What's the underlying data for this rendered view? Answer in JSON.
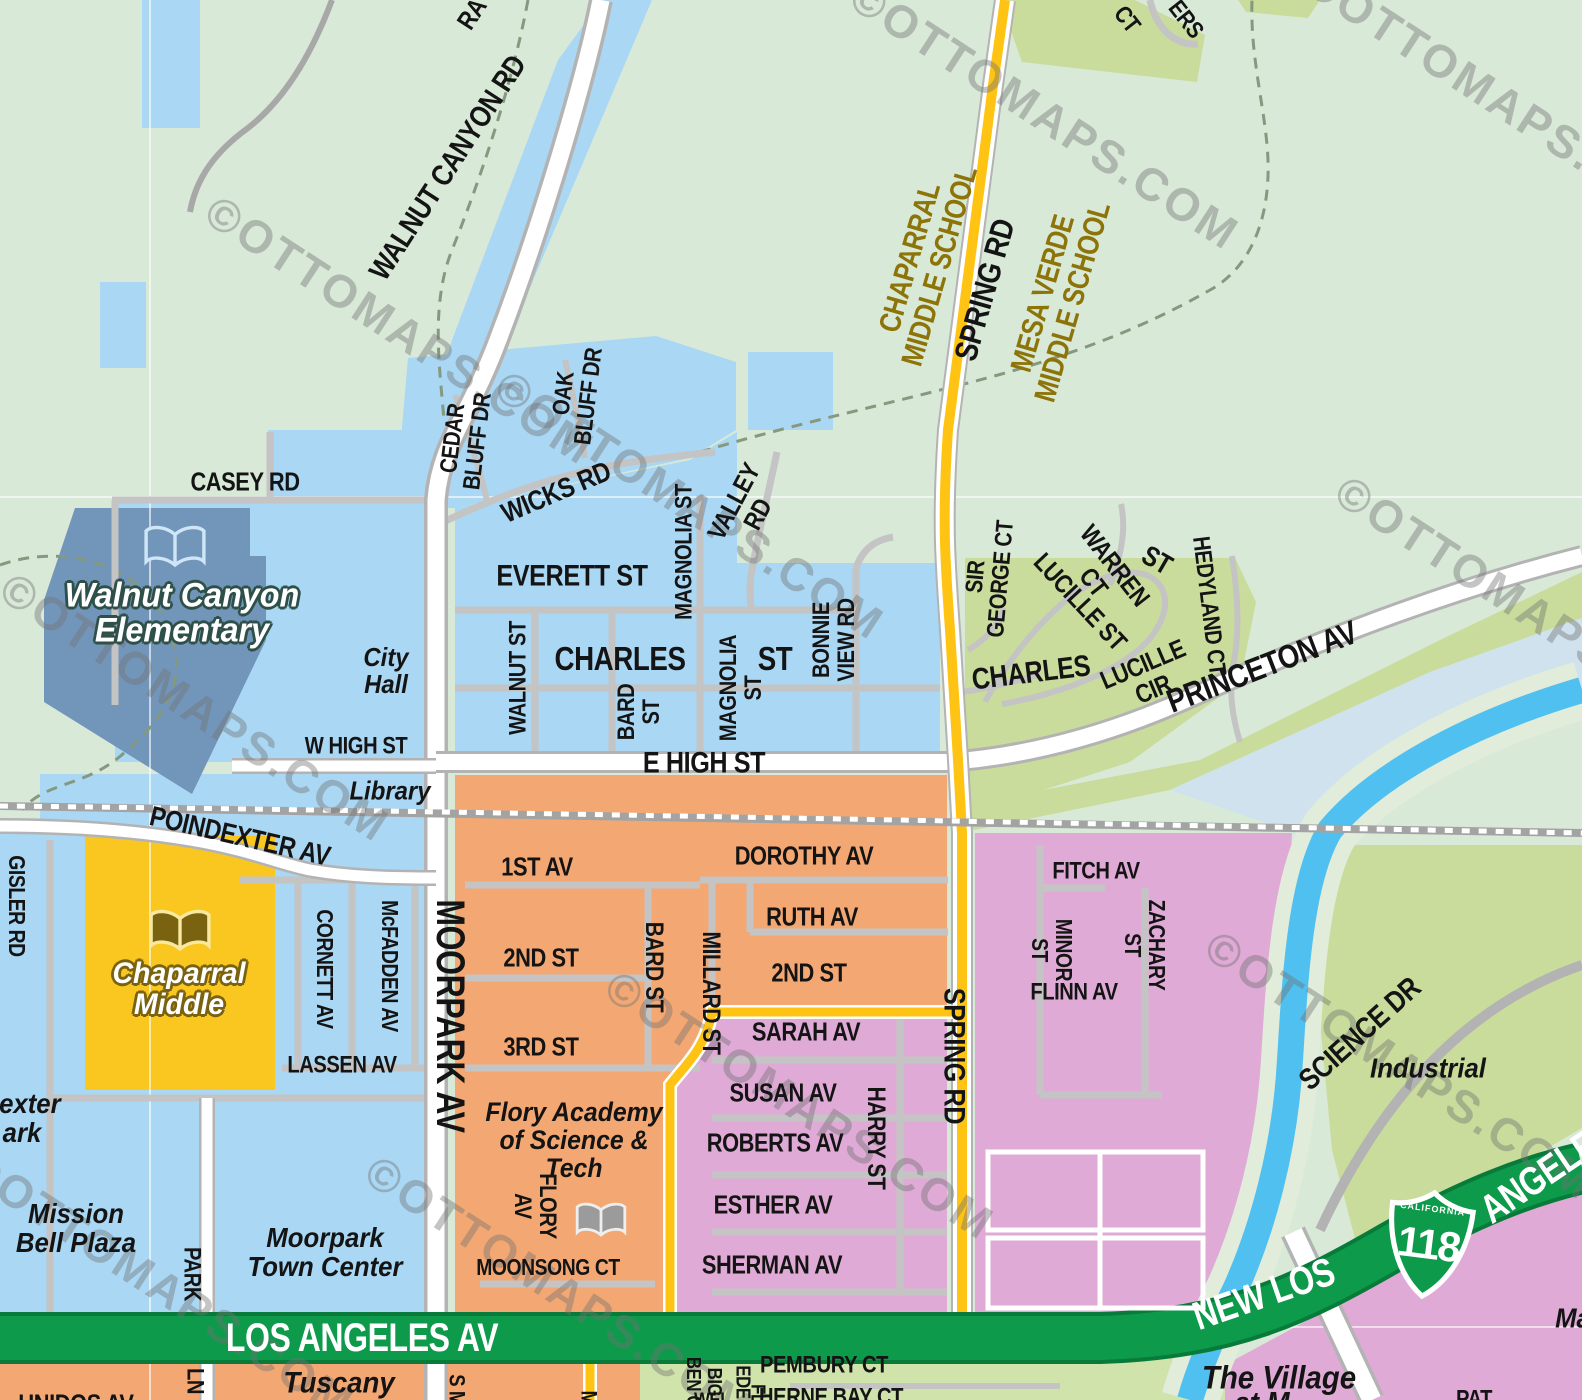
{
  "map": {
    "watermark_text": "©OTTOMAPS.COM",
    "shield": {
      "state": "CALIFORNIA",
      "number": "118"
    },
    "colors": {
      "park_green": "#d9e9d8",
      "residential_blue": "#a9d7f4",
      "downtown_orange": "#f3a873",
      "south_pink": "#dfaad6",
      "hill_green": "#c9dc9b",
      "school_yellow": "#f9c71f",
      "school_site_blue": "#7295ba",
      "river_blue": "#4fc0f0",
      "la_av_green": "#0d9a4b",
      "spring_rd_yellow": "#ffc413",
      "school_label_gold": "#8d7408"
    },
    "labels": {
      "walnut_canyon_rd": {
        "text": "WALNUT CANYON RD"
      },
      "ra_fragment": {
        "text": "RA"
      },
      "chaparral_middle_school": {
        "text": "CHAPARRAL\nMIDDLE SCHOOL"
      },
      "spring_rd_upper": {
        "text": "SPRING RD"
      },
      "mesa_verde_middle_school": {
        "text": "MESA VERDE\nMIDDLE SCHOOL"
      },
      "ct_fragment": {
        "text": "CT"
      },
      "ers_fragment": {
        "text": "ERS"
      },
      "casey_rd": {
        "text": "CASEY RD"
      },
      "walnut_canyon_elementary": {
        "text": "Walnut Canyon\nElementary"
      },
      "city_hall": {
        "text": "City\nHall"
      },
      "library": {
        "text": "Library"
      },
      "cedar_bluff_dr": {
        "text": "CEDAR\nBLUFF DR"
      },
      "oak_bluff_dr": {
        "text": "OAK\nBLUFF DR"
      },
      "wicks_rd": {
        "text": "WICKS RD"
      },
      "everett_st": {
        "text": "EVERETT ST"
      },
      "walnut_st": {
        "text": "WALNUT ST"
      },
      "charles_st": {
        "text": "CHARLES"
      },
      "charles_st_suffix": {
        "text": "ST"
      },
      "magnolia_st_n": {
        "text": "MAGNOLIA ST"
      },
      "magnolia_st_s": {
        "text": "MAGNOLIA\nST"
      },
      "bard_st_n": {
        "text": "BARD\nST"
      },
      "valley_rd": {
        "text": "VALLEY\nRD"
      },
      "bonnie_view_rd": {
        "text": "BONNIE\nVIEW RD"
      },
      "w_high_st": {
        "text": "W HIGH ST"
      },
      "e_high_st": {
        "text": "E HIGH ST"
      },
      "poindexter_av": {
        "text": "POINDEXTER AV"
      },
      "sir_george_ct": {
        "text": "SIR\nGEORGE CT"
      },
      "warren_ct": {
        "text": "WARREN\nCT"
      },
      "st_fragment": {
        "text": "ST"
      },
      "lucille_st": {
        "text": "LUCILLE ST"
      },
      "lucille_cir": {
        "text": "LUCILLE\nCIR"
      },
      "hedyland_ct": {
        "text": "HEDYLAND CT"
      },
      "princeton_av": {
        "text": "PRINCETON AV"
      },
      "charles_st_e": {
        "text": "CHARLES"
      },
      "gisler_rd": {
        "text": "GISLER RD"
      },
      "chaparral_middle": {
        "text": "Chaparral\nMiddle"
      },
      "cornett_av": {
        "text": "CORNETT AV"
      },
      "mcfadden_av": {
        "text": "McFADDEN AV"
      },
      "lassen_av": {
        "text": "LASSEN AV"
      },
      "moorpark_av": {
        "text": "MOORPARK AV"
      },
      "first_av": {
        "text": "1ST AV"
      },
      "dorothy_av": {
        "text": "DOROTHY AV"
      },
      "ruth_av": {
        "text": "RUTH AV"
      },
      "second_st_w": {
        "text": "2ND ST"
      },
      "second_st_e": {
        "text": "2ND ST"
      },
      "third_st": {
        "text": "3RD ST"
      },
      "bard_st_s": {
        "text": "BARD ST"
      },
      "millard_st": {
        "text": "MILLARD ST"
      },
      "sarah_av": {
        "text": "SARAH AV"
      },
      "susan_av": {
        "text": "SUSAN AV"
      },
      "roberts_av": {
        "text": "ROBERTS AV"
      },
      "esther_av": {
        "text": "ESTHER AV"
      },
      "sherman_av": {
        "text": "SHERMAN AV"
      },
      "harry_st": {
        "text": "HARRY ST"
      },
      "spring_rd_lower": {
        "text": "SPRING RD"
      },
      "fitch_av": {
        "text": "FITCH AV"
      },
      "minor_st": {
        "text": "MINOR\nST"
      },
      "zachary_st": {
        "text": "ZACHARY\nST"
      },
      "flinn_av": {
        "text": "FLINN AV"
      },
      "science_dr": {
        "text": "SCIENCE DR"
      },
      "industrial": {
        "text": "Industrial"
      },
      "mission_bell_plaza": {
        "text": "Mission\nBell Plaza"
      },
      "poindexter_park_fragment": {
        "text": "dexter\nark"
      },
      "park_ln_upper": {
        "text": "PARK"
      },
      "park_ln_lower": {
        "text": "LN"
      },
      "moorpark_town_center": {
        "text": "Moorpark\nTown Center"
      },
      "flory_academy": {
        "text": "Flory Academy\nof Science &\nTech"
      },
      "flory_av": {
        "text": "FLORY\nAV"
      },
      "moonsong_ct": {
        "text": "MOONSONG CT"
      },
      "los_angeles_av": {
        "text": "LOS ANGELES AV"
      },
      "new_los": {
        "text": "NEW LOS"
      },
      "angeles": {
        "text": "ANGELES"
      },
      "tuscany": {
        "text": "Tuscany"
      },
      "unidos_av_fragment": {
        "text": "UNIDOS AV"
      },
      "s_m_fragment": {
        "text": "S M"
      },
      "m_fragment": {
        "text": "M"
      },
      "big_ben_fragment": {
        "text": "BIG\nBEN C"
      },
      "wel_fragment": {
        "text": "WEL"
      },
      "ede_fragment": {
        "text": "EDE"
      },
      "fl_fragment": {
        "text": "FL"
      },
      "pembury_ct": {
        "text": "PEMBURY CT"
      },
      "herne_bay_ct": {
        "text": "HERNE BAY CT"
      },
      "the_village": {
        "text": "The Village"
      },
      "at_m_fragment": {
        "text": "at M"
      },
      "ma_fragment": {
        "text": "Ma"
      },
      "pat_fragment": {
        "text": "PAT"
      }
    }
  }
}
